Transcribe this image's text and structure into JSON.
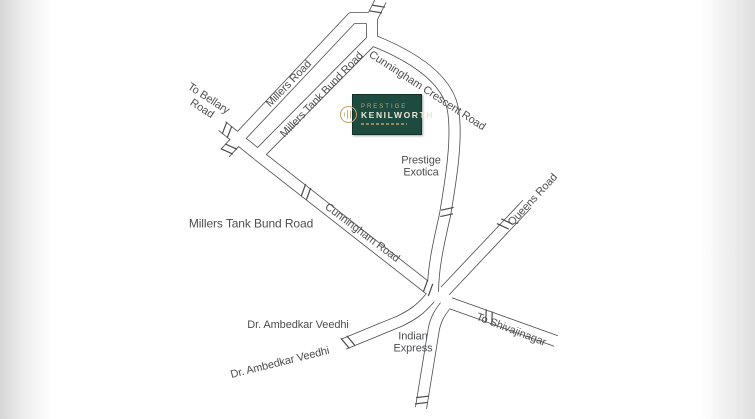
{
  "map": {
    "logo": {
      "brand": "PRESTIGE",
      "project": "KENILWORTH"
    },
    "road_labels": {
      "to_bellary_line1": "To Bellary",
      "to_bellary_line2": "Road",
      "millers_road": "Millers Road",
      "millers_tank_bund_road_along": "Millers Tank Bund Road",
      "millers_tank_bund_road": "Millers Tank Bund Road",
      "cunningham_crescent_road": "Cunningham Crescent Road",
      "cunningham_road": "Cunningham Road",
      "queens_road": "Queens Road",
      "dr_ambedkar_veedhi_horizontal": "Dr. Ambedkar Veedhi",
      "dr_ambedkar_veedhi_diagonal": "Dr. Ambedkar Veedhi",
      "to_shivajinagar": "To Shivajinagar"
    },
    "landmarks": {
      "prestige_exotica_line1": "Prestige",
      "prestige_exotica_line2": "Exotica",
      "indian_express_line1": "Indian",
      "indian_express_line2": "Express"
    },
    "colors": {
      "background": "#ffffff",
      "road_line": "#4a4b4d",
      "label_text": "#4d4e50",
      "logo_green": "#1e4b40",
      "logo_gold": "#c2a169",
      "logo_cream": "#ece5d3"
    }
  }
}
